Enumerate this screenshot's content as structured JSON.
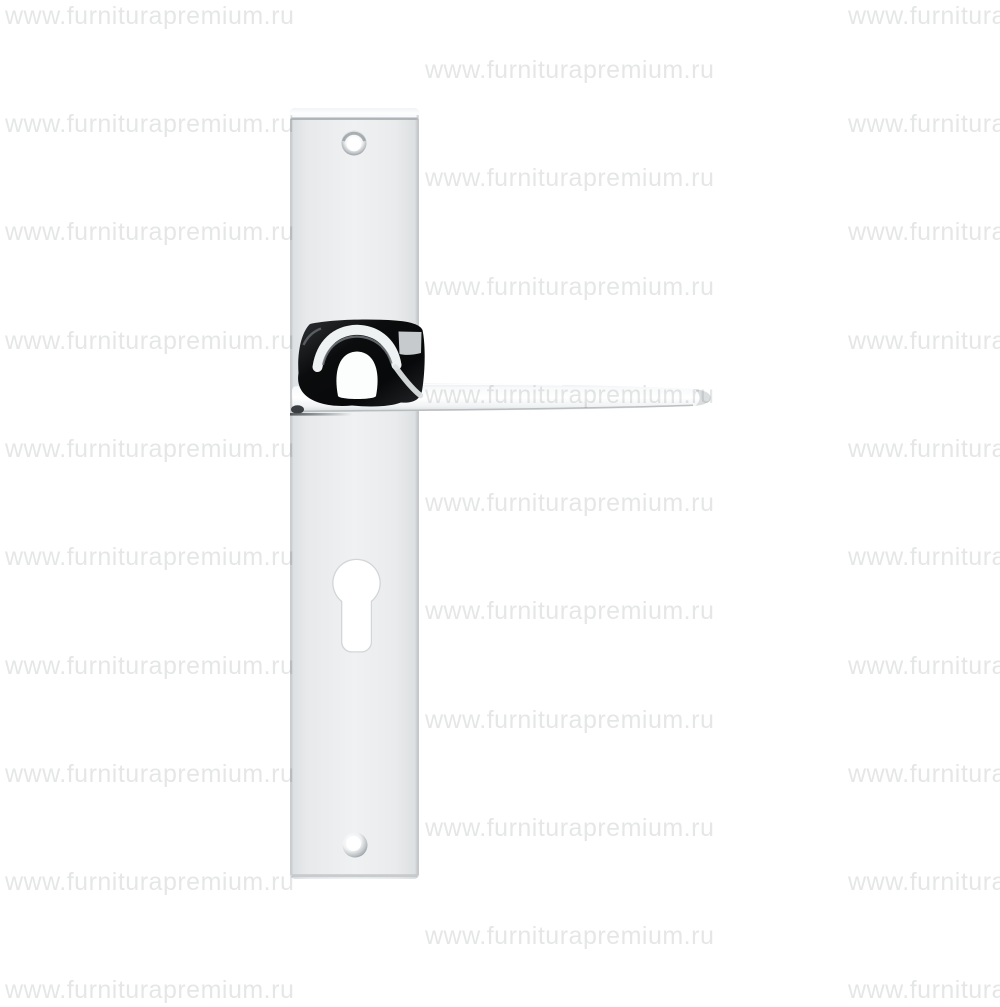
{
  "background_color": "#ffffff",
  "watermark": {
    "text": "www.furniturapremium.ru",
    "color_hex": "#e5e6e7",
    "grid": {
      "rows": 19,
      "row_spacing_px": 54,
      "columns": [
        "left",
        "center",
        "right"
      ],
      "visible_instances": 29
    }
  },
  "product_colors": {
    "chrome_face_light": "#f0f2f3",
    "chrome_face_mid": "#e9ebec",
    "chrome_edge_gray": "#c9cdd0",
    "neck_reflection_dark": "#0b0c0d",
    "hole_white": "#ffffff"
  }
}
